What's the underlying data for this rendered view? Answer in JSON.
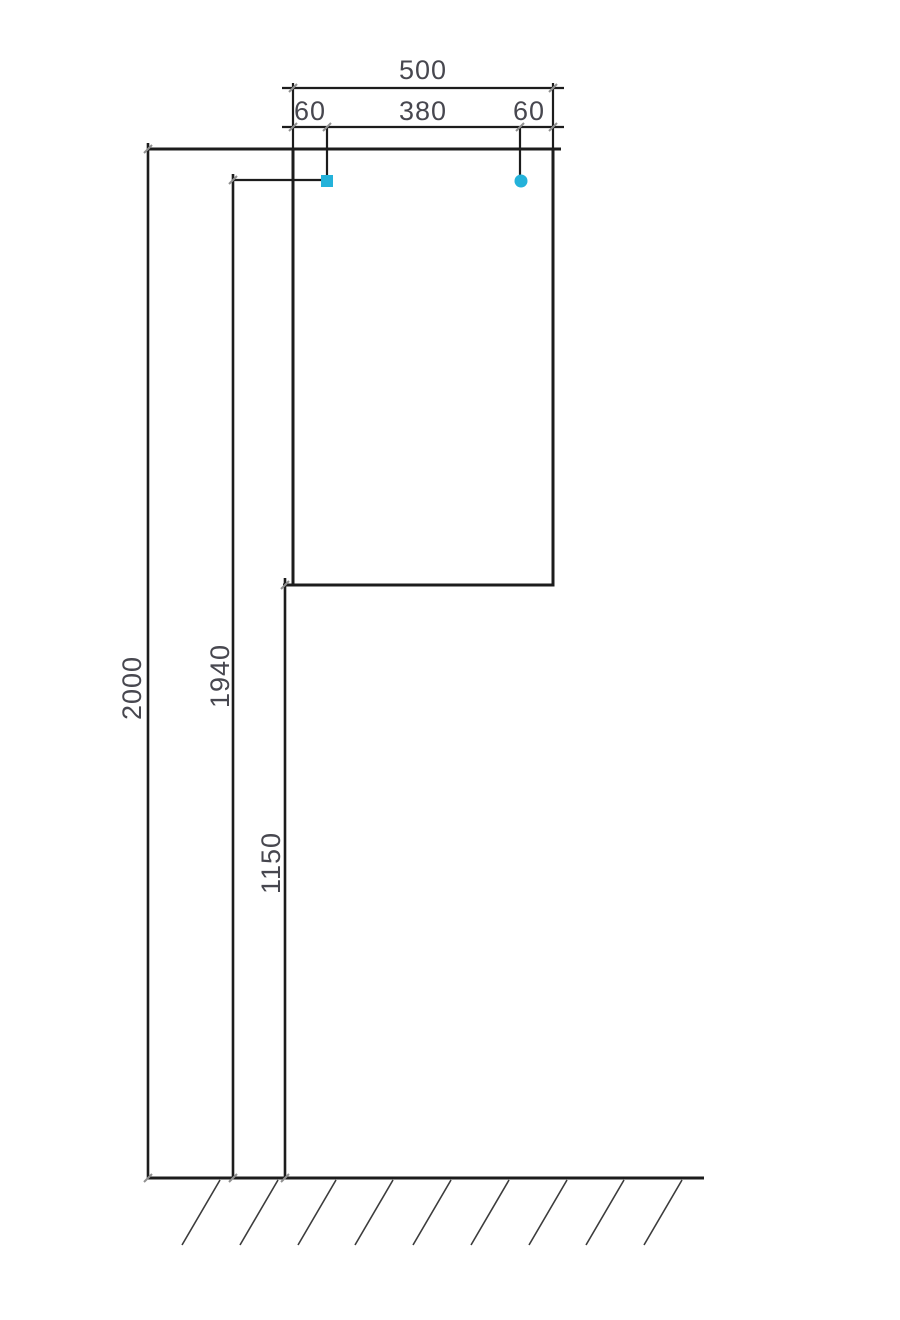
{
  "drawing": {
    "type": "installation-diagram",
    "units": "mm",
    "dimensions": {
      "width_total": "500",
      "mount_offset_left": "60",
      "mount_spacing": "380",
      "mount_offset_right": "60",
      "height_total": "2000",
      "mount_height": "1940",
      "cabinet_bottom_height": "1150"
    },
    "colors": {
      "line": "#1c1c1c",
      "hatch": "#3c3c3c",
      "tick": "#909090",
      "label": "#47474f",
      "marker": "#24b2da",
      "background": "#ffffff"
    },
    "markers": [
      {
        "id": "left-mount-point",
        "shape": "square"
      },
      {
        "id": "right-mount-point",
        "shape": "circle"
      }
    ]
  }
}
